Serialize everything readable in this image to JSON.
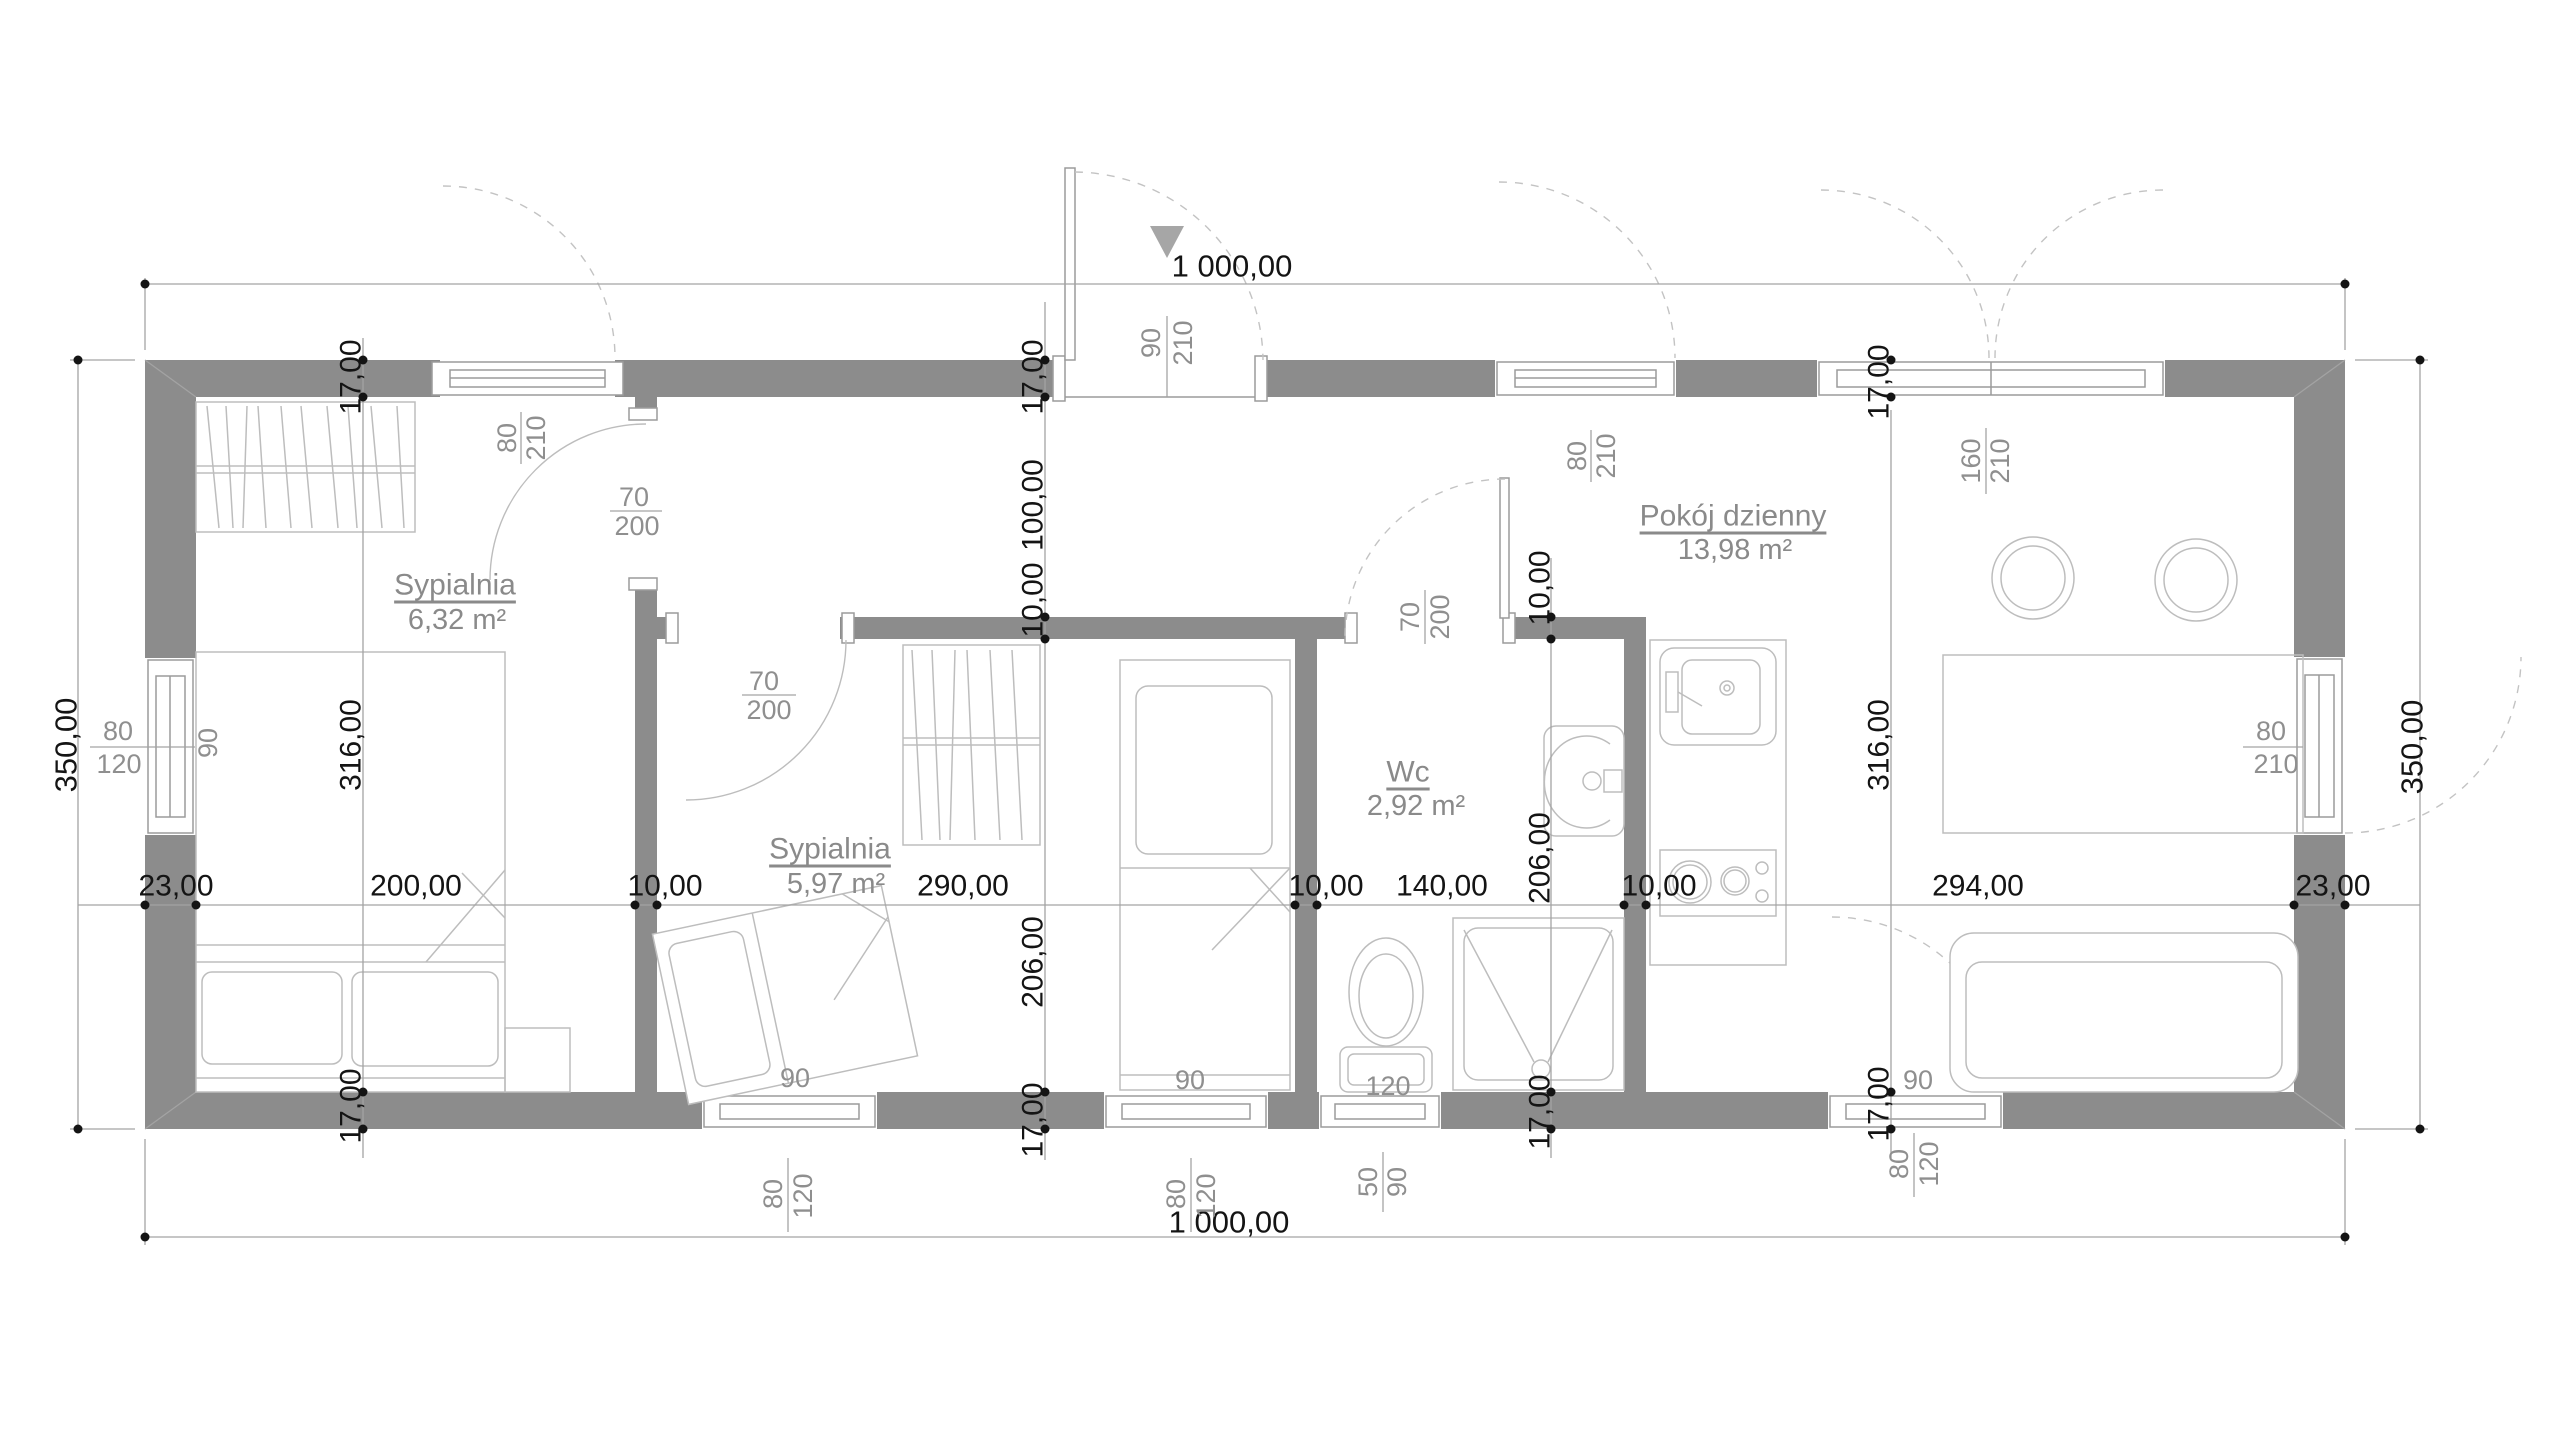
{
  "app": {
    "type": "cad-floor-plan",
    "background": "#ffffff"
  },
  "rooms": [
    {
      "name": "Sypialnia",
      "area": "6,32 m²"
    },
    {
      "name": "Sypialnia",
      "area": "5,97 m²"
    },
    {
      "name": "Wc",
      "area": "2,92 m²"
    },
    {
      "name": "Pokój dzienny",
      "area": "13,98 m²"
    }
  ],
  "overall": {
    "top": "1 000,00",
    "bottom": "1 000,00",
    "left": "350,00",
    "right": "350,00"
  },
  "chain_horizontal": [
    "23,00",
    "200,00",
    "10,00",
    "290,00",
    "10,00",
    "140,00",
    "10,00",
    "294,00",
    "23,00"
  ],
  "chain_left": [
    "17,00",
    "316,00",
    "17,00"
  ],
  "chain_middle": [
    "17,00",
    "100,00",
    "10,00",
    "206,00",
    "17,00"
  ],
  "chain_wc": [
    "10,00",
    "206,00",
    "17,00"
  ],
  "chain_right": [
    "17,00",
    "316,00",
    "17,00"
  ],
  "openings": {
    "window_top_bedroom1": {
      "width": "80",
      "height": "210"
    },
    "entrance_door": {
      "width": "90",
      "height": "210"
    },
    "window_top_living": {
      "width": "80",
      "height": "210"
    },
    "window_top_living_double": {
      "width": "160",
      "height": "210"
    },
    "window_left": {
      "sill": "90",
      "width": "80",
      "height": "120"
    },
    "door_right": {
      "width": "80",
      "height": "210"
    },
    "window_bottom_bedroom2_a": {
      "sill": "90",
      "width": "80",
      "height": "120"
    },
    "window_bottom_bedroom2_b": {
      "sill": "90",
      "width": "80",
      "height": "120"
    },
    "window_bottom_wc": {
      "sill": "120",
      "width": "50",
      "height": "90"
    },
    "window_bottom_living": {
      "sill": "90",
      "width": "80",
      "height": "120"
    },
    "door_bedroom1": {
      "width": "70",
      "height": "200"
    },
    "door_bedroom2": {
      "width": "70",
      "height": "200"
    },
    "door_wc": {
      "width": "70",
      "height": "200"
    }
  },
  "colors": {
    "wall": "#8c8c8c",
    "dim_text": "#141414",
    "label_text": "#8f8f8f",
    "line": "#a3a3a3",
    "furniture": "#bdbdbd",
    "entrance_arrow": "#a6a6a6"
  }
}
